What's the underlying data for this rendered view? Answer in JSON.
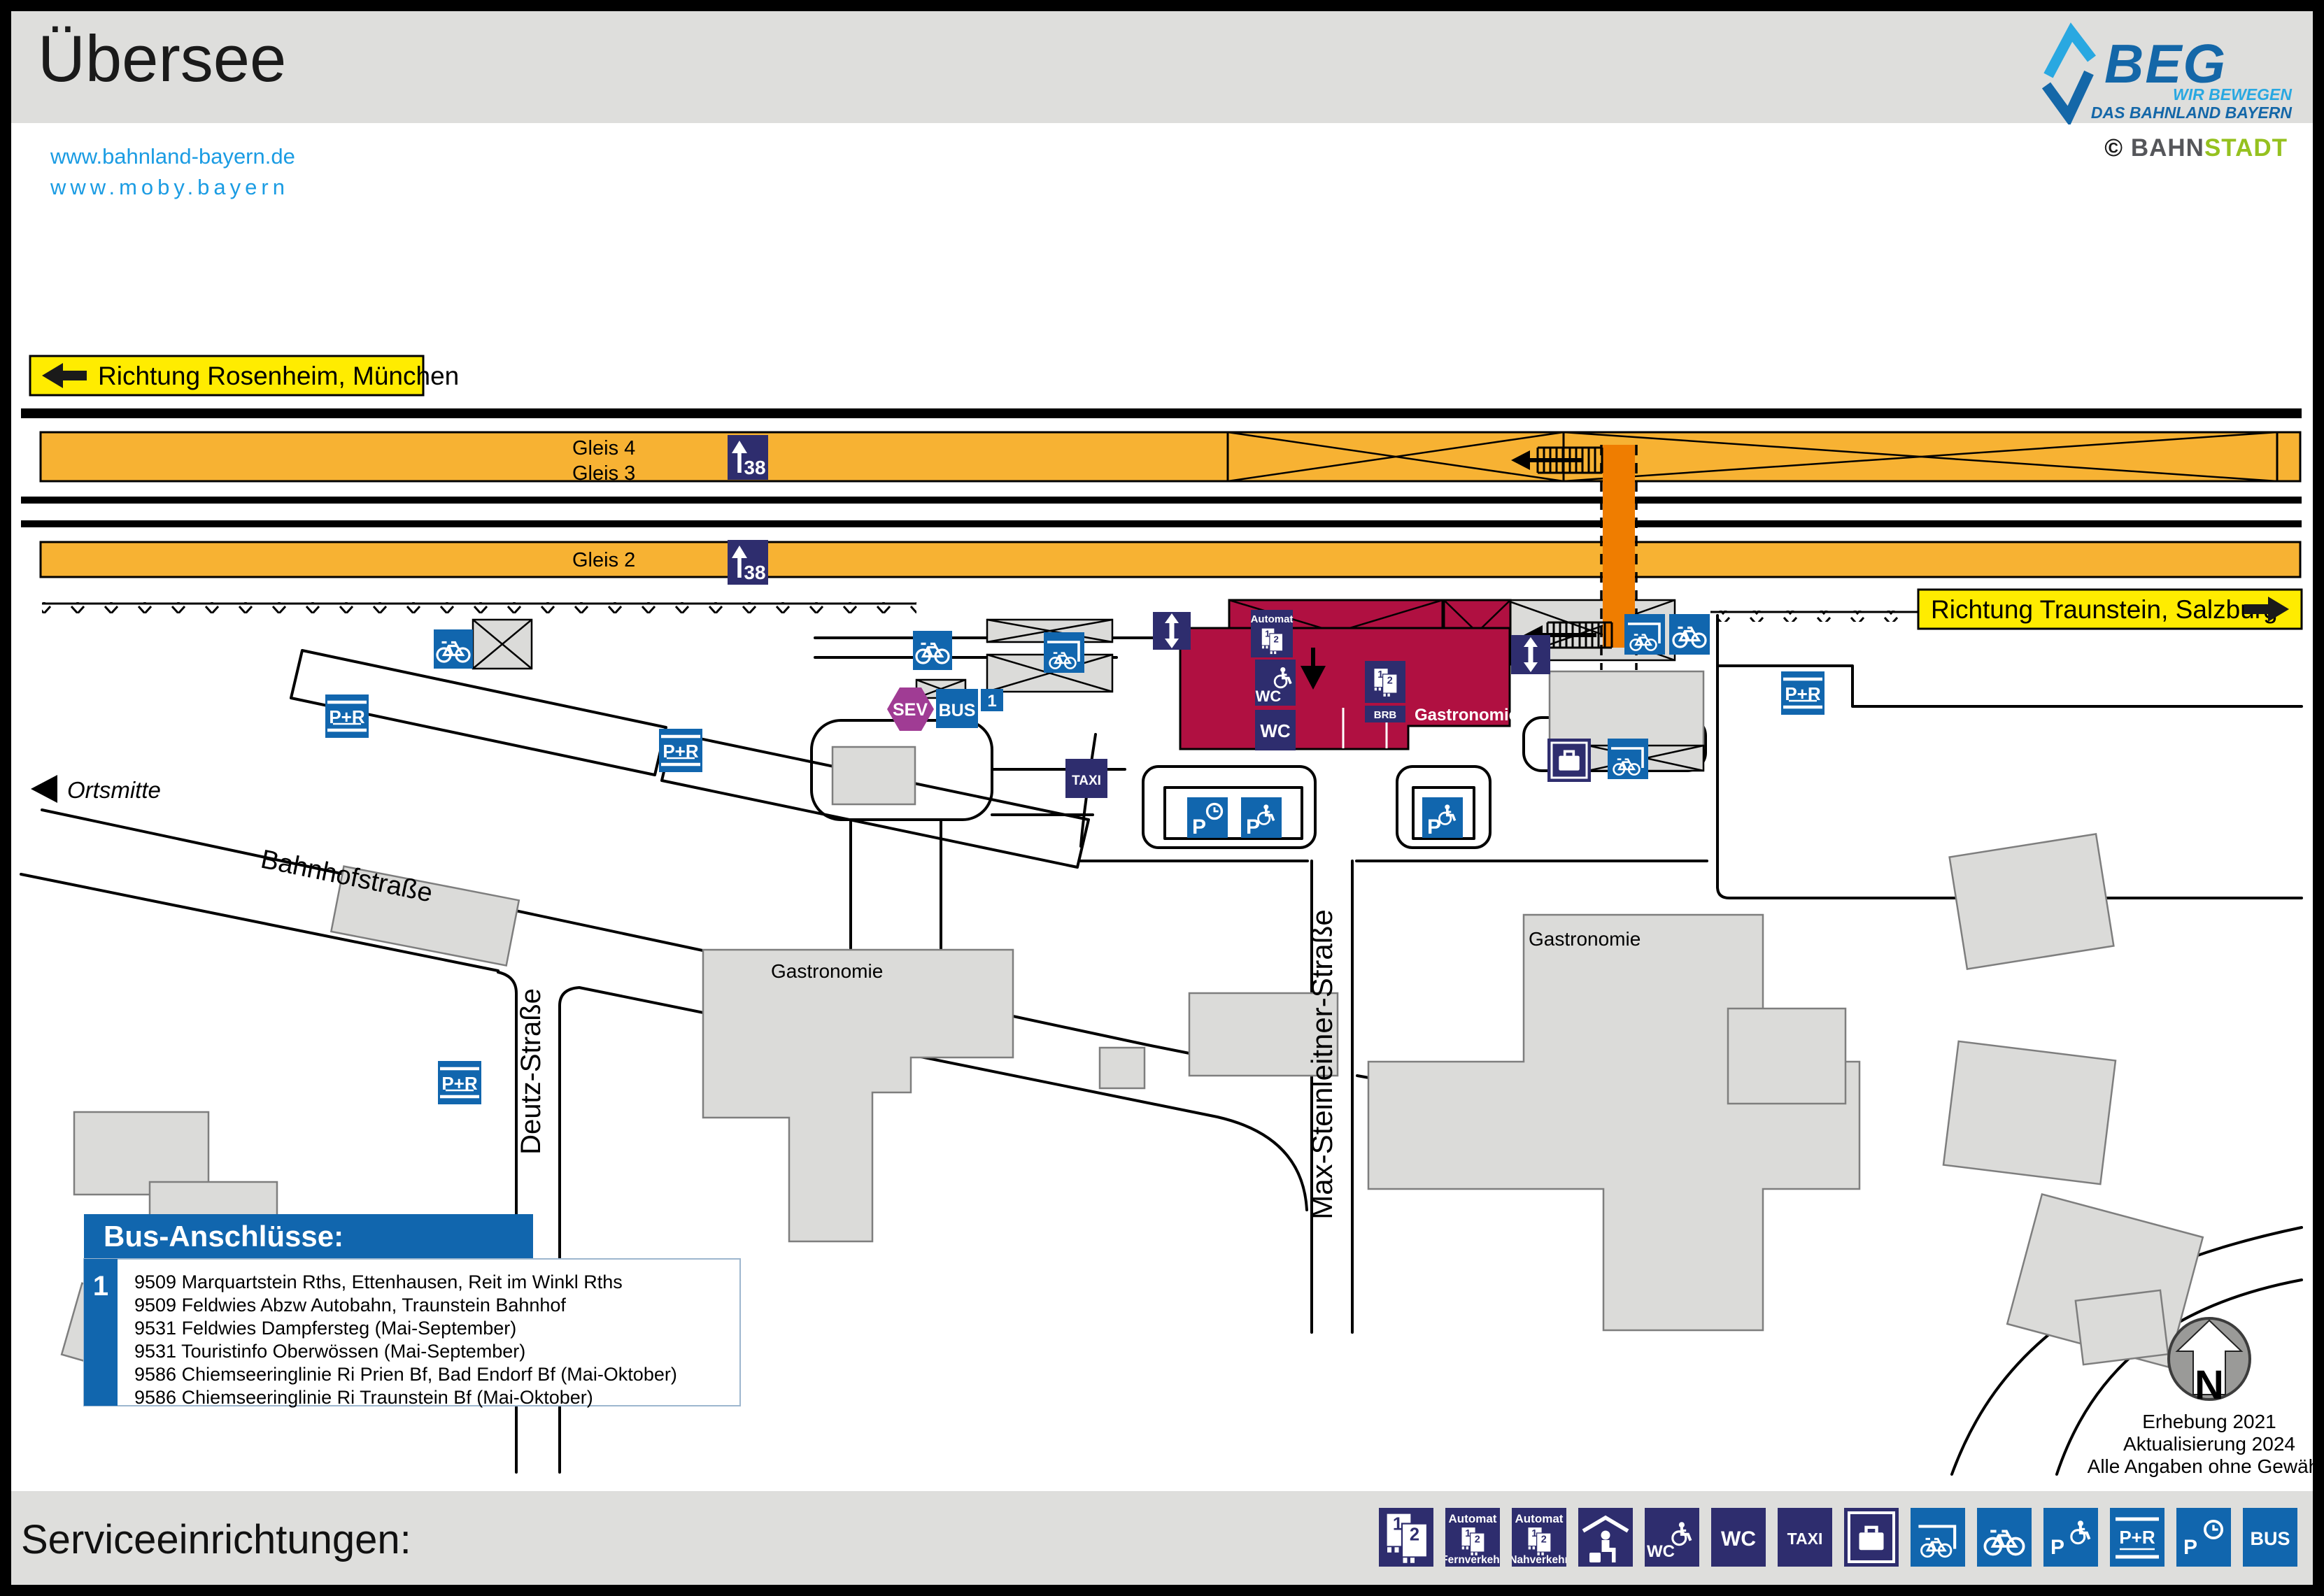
{
  "header": {
    "title": "Übersee",
    "links": [
      "www.bahnland-bayern.de",
      "www.moby.bayern"
    ],
    "beg": {
      "name": "BEG",
      "tagline1": "WIR BEWEGEN",
      "tagline2": "DAS BAHNLAND BAYERN"
    },
    "copyright": {
      "symbol": "©",
      "bahn": "BAHN",
      "stadt": "STADT"
    }
  },
  "signs": {
    "west": "Richtung Rosenheim, München",
    "east": "Richtung Traunstein, Salzburg"
  },
  "platforms": {
    "gleis4": "Gleis 4",
    "gleis3": "Gleis 3",
    "gleis2": "Gleis 2",
    "height": "38"
  },
  "streets": {
    "bahnhofstrasse": "Bahnhofstraße",
    "deutz": "Deutz-Straße",
    "max_steinleitner": "Max-Steinleitner-Straße",
    "ortsmitte": "Ortsmitte"
  },
  "poi": {
    "gastronomie": "Gastronomie",
    "automat": "Automat",
    "brb": "BRB",
    "wc": "WC",
    "taxi": "TAXI",
    "sev": "SEV",
    "bus": "BUS",
    "stop1": "1",
    "pr": "P+R",
    "p": "P",
    "ticket1": "1",
    "ticket2": "2"
  },
  "bus_box": {
    "title": "Bus-Anschlüsse:",
    "stop": "1",
    "lines": [
      "9509 Marquartstein Rths, Ettenhausen, Reit im Winkl Rths",
      "9509 Feldwies Abzw Autobahn, Traunstein Bahnhof",
      "9531 Feldwies Dampfersteg (Mai-September)",
      "9531 Touristinfo Oberwössen (Mai-September)",
      "9586 Chiemseeringlinie Ri Prien Bf, Bad Endorf Bf (Mai-Oktober)",
      "9586 Chiemseeringlinie Ri Traunstein Bf (Mai-Oktober)"
    ]
  },
  "north": {
    "letter": "N",
    "notes": [
      "Erhebung 2021",
      "Aktualisierung 2024",
      "Alle Angaben ohne Gewähr!"
    ]
  },
  "footer": {
    "title": "Serviceeinrichtungen:",
    "icons": [
      {
        "id": "ticket-counter"
      },
      {
        "id": "automat-fernverkehr",
        "top": "Automat",
        "bottom": "Fernverkehr"
      },
      {
        "id": "automat-nahverkehr",
        "top": "Automat",
        "bottom": "Nahverkehr"
      },
      {
        "id": "waiting-area"
      },
      {
        "id": "wc-accessible",
        "label": "WC"
      },
      {
        "id": "wc",
        "label": "WC"
      },
      {
        "id": "taxi",
        "label": "TAXI"
      },
      {
        "id": "lockers"
      },
      {
        "id": "bike-covered"
      },
      {
        "id": "bike"
      },
      {
        "id": "parking-accessible",
        "label": "P"
      },
      {
        "id": "park-and-ride",
        "label": "P+R"
      },
      {
        "id": "parking-short-term",
        "label": "P"
      },
      {
        "id": "bus",
        "label": "BUS"
      }
    ]
  },
  "colors": {
    "navy": "#2E2D6E",
    "blue": "#1166AE",
    "orange_platform": "#F7B233",
    "orange_crossing": "#EF7D00",
    "red_building": "#B01041",
    "yellow_sign": "#FFEC00",
    "purple_sev": "#A03C94",
    "link_blue": "#1B9CE3",
    "beg_blue": "#1467A8",
    "beg_lightblue": "#29A8E1",
    "bahnstadt_green": "#95C11F",
    "building_gray": "#DBDBD9"
  }
}
